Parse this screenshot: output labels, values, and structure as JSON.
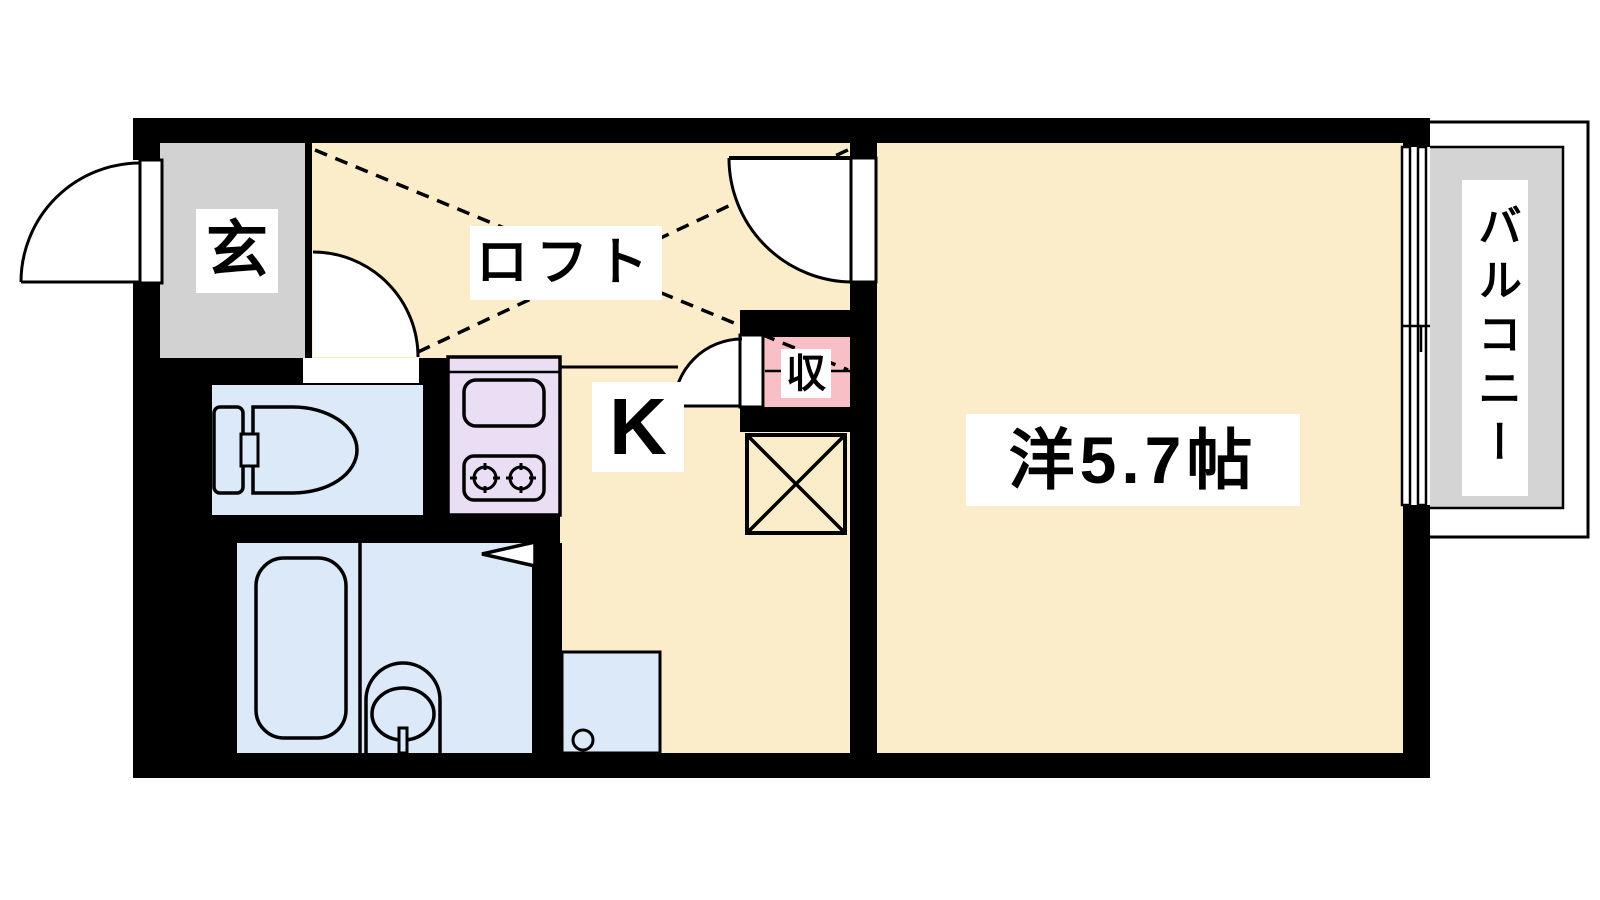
{
  "plan": {
    "type": "apartment-floor-plan",
    "rooms": {
      "entrance": {
        "label": "玄"
      },
      "loft": {
        "label": "ロフト"
      },
      "kitchen": {
        "label": "K"
      },
      "closet": {
        "label": "収"
      },
      "western_room": {
        "label": "洋5.7帖",
        "size_tatami": "5.7"
      },
      "balcony": {
        "label": "バルコニー"
      }
    }
  },
  "colors": {
    "wall": "#000000",
    "floor_cream": "#FBEDC9",
    "water_blue": "#DBE9F9",
    "stove_purple": "#E9DEF4",
    "closet_pink": "#F8BFC7",
    "entrance_gray": "#D2D2D2",
    "balcony_gray": "#D4D4D4",
    "label_bg": "#FFFFFF",
    "line": "#000000",
    "canvas_bg": "#FFFFFF"
  }
}
